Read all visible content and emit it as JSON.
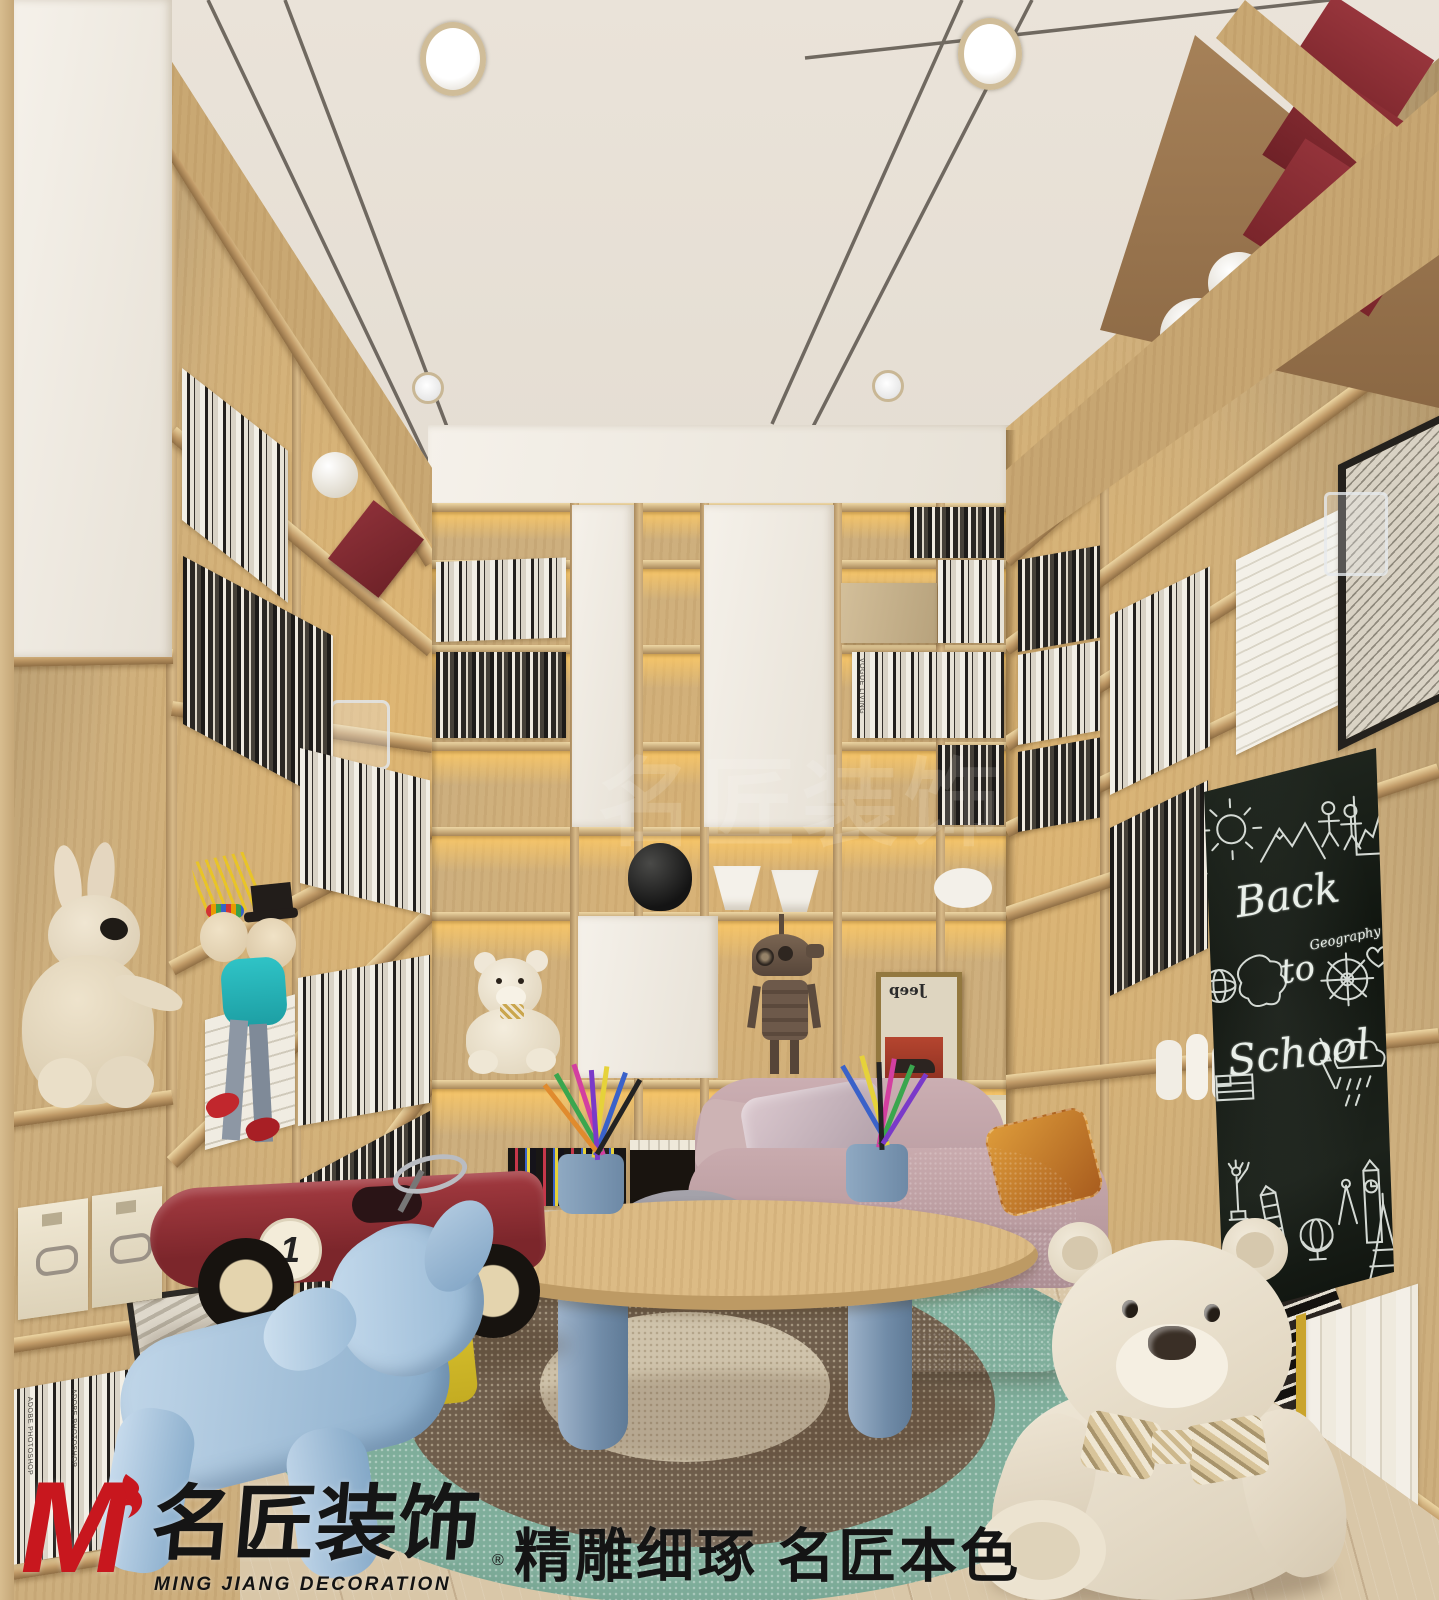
{
  "brand": {
    "logo_m": "M",
    "name_cn": "名匠装饰",
    "name_en": "MING JIANG DECORATION",
    "registered_mark": "®",
    "slogan": "精雕细琢  名匠本色",
    "logo_red": "#c8171e"
  },
  "watermark": {
    "text": "名匠装饰"
  },
  "blackboard": {
    "title_line1": "Back",
    "title_line2": "to",
    "title_line3": "School",
    "side_label": "Geography",
    "board_color": "#141a15",
    "chalk_color": "#e9efe9",
    "doodle_icons": [
      "pencil-icon",
      "sun-icon",
      "mountains-icon",
      "stick-figures-icon",
      "line-chart-icon",
      "earth-icon",
      "map-icon",
      "ship-wheel-icon",
      "heart-icon",
      "lightning-icon",
      "rain-cloud-icon",
      "usa-flag-icon",
      "statue-of-liberty-icon",
      "pisa-tower-icon",
      "desk-globe-icon",
      "compass-icon",
      "big-ben-icon",
      "eiffel-tower-icon"
    ]
  },
  "shelf_items": {
    "poster_text": "Jeep",
    "race_car_number": "1",
    "book_spine_labels": [
      "ADOBE PHOTOSHOP",
      "LOKKLA",
      "VOGUE LIVING"
    ]
  },
  "palette": {
    "wood": "#cdaf7e",
    "wood_lit": "#f0d49c",
    "ceiling": "#e8e1d7",
    "floor": "#d8c5a6",
    "rug_outer": "#7fae9b",
    "rug_middle": "#6f5e4c",
    "rug_center": "#cfc3ab",
    "sofa_pink": "#c4a6a9",
    "chair_blue": "#7b98b6",
    "toy_car_red": "#8e2b2e",
    "puppy_blue": "#a9c4dd",
    "accent_yellow": "#ddc52f"
  }
}
